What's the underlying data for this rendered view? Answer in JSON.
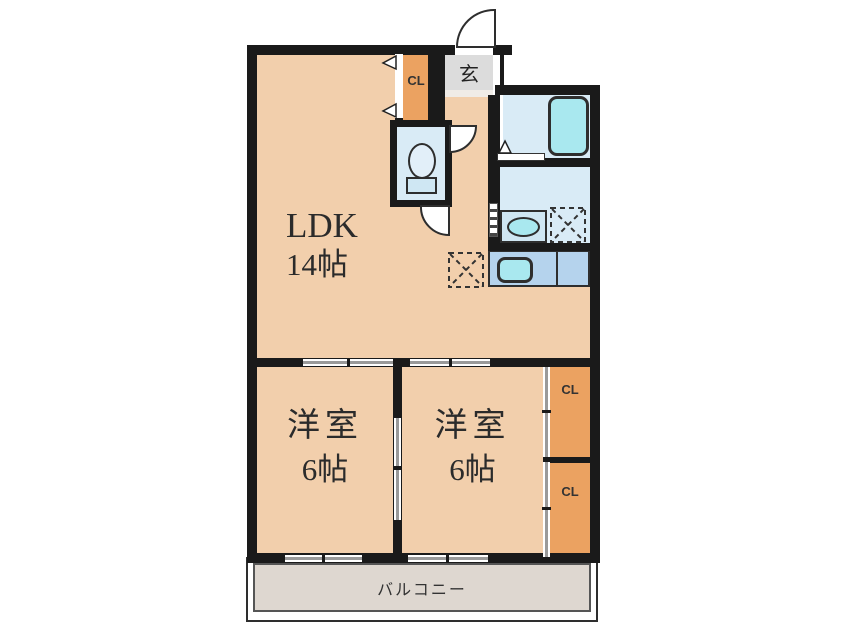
{
  "document": {
    "type": "japanese-apartment-floor-plan"
  },
  "rooms": {
    "ldk": {
      "name": "LDK",
      "size": "14帖"
    },
    "bedroom_left": {
      "name": "洋室",
      "size": "6帖"
    },
    "bedroom_right": {
      "name": "洋室",
      "size": "6帖"
    },
    "entrance": {
      "label": "玄"
    },
    "closet_entrance": {
      "label": "CL"
    },
    "closet_upper_right": {
      "label": "CL"
    },
    "closet_lower_right": {
      "label": "CL"
    },
    "balcony": {
      "label": "バルコニー"
    }
  },
  "fixtures": {
    "bathtub": "bathtub",
    "toilet": "toilet",
    "washbasin": "washbasin",
    "washing_machine_space": "washing-machine-space",
    "refrigerator_space": "refrigerator-space",
    "kitchen_sink": "kitchen-sink",
    "kitchen_counter": "kitchen-counter"
  },
  "colors": {
    "floor": "#f2cfac",
    "closet": "#eba261",
    "wet_floor": "#d9ebf6",
    "fixture_cyan": "#a9e8ef",
    "kitchen_counter": "#b5d3ed",
    "entrance_tile": "#dcdcdc",
    "balcony_floor": "#ded7d0",
    "wall": "#1a1a1a",
    "background": "#ffffff"
  }
}
